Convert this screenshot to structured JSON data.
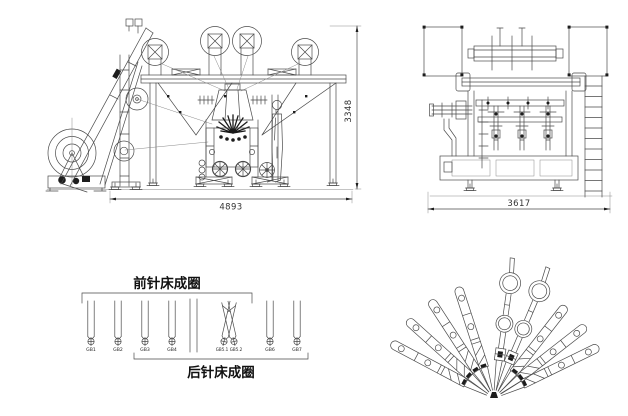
{
  "drawing": {
    "front_view": {
      "width_dimension": "4893",
      "height_dimension": "3348"
    },
    "side_view": {
      "depth_dimension": "3617"
    },
    "guide_bar_diagram": {
      "front_needle_bed_label": "前针床成圈",
      "back_needle_bed_label": "后针床成圈",
      "guide_bars": [
        {
          "label": "GB1"
        },
        {
          "label": "GB2"
        },
        {
          "label": "GB3"
        },
        {
          "label": "GB4"
        },
        {
          "label": "GB5.1"
        },
        {
          "label": "GB5.2"
        },
        {
          "label": "GB6"
        },
        {
          "label": "GB7"
        }
      ]
    },
    "colors": {
      "line": "#4a4a4a",
      "dark": "#1d1d1d",
      "background": "#ffffff"
    }
  }
}
